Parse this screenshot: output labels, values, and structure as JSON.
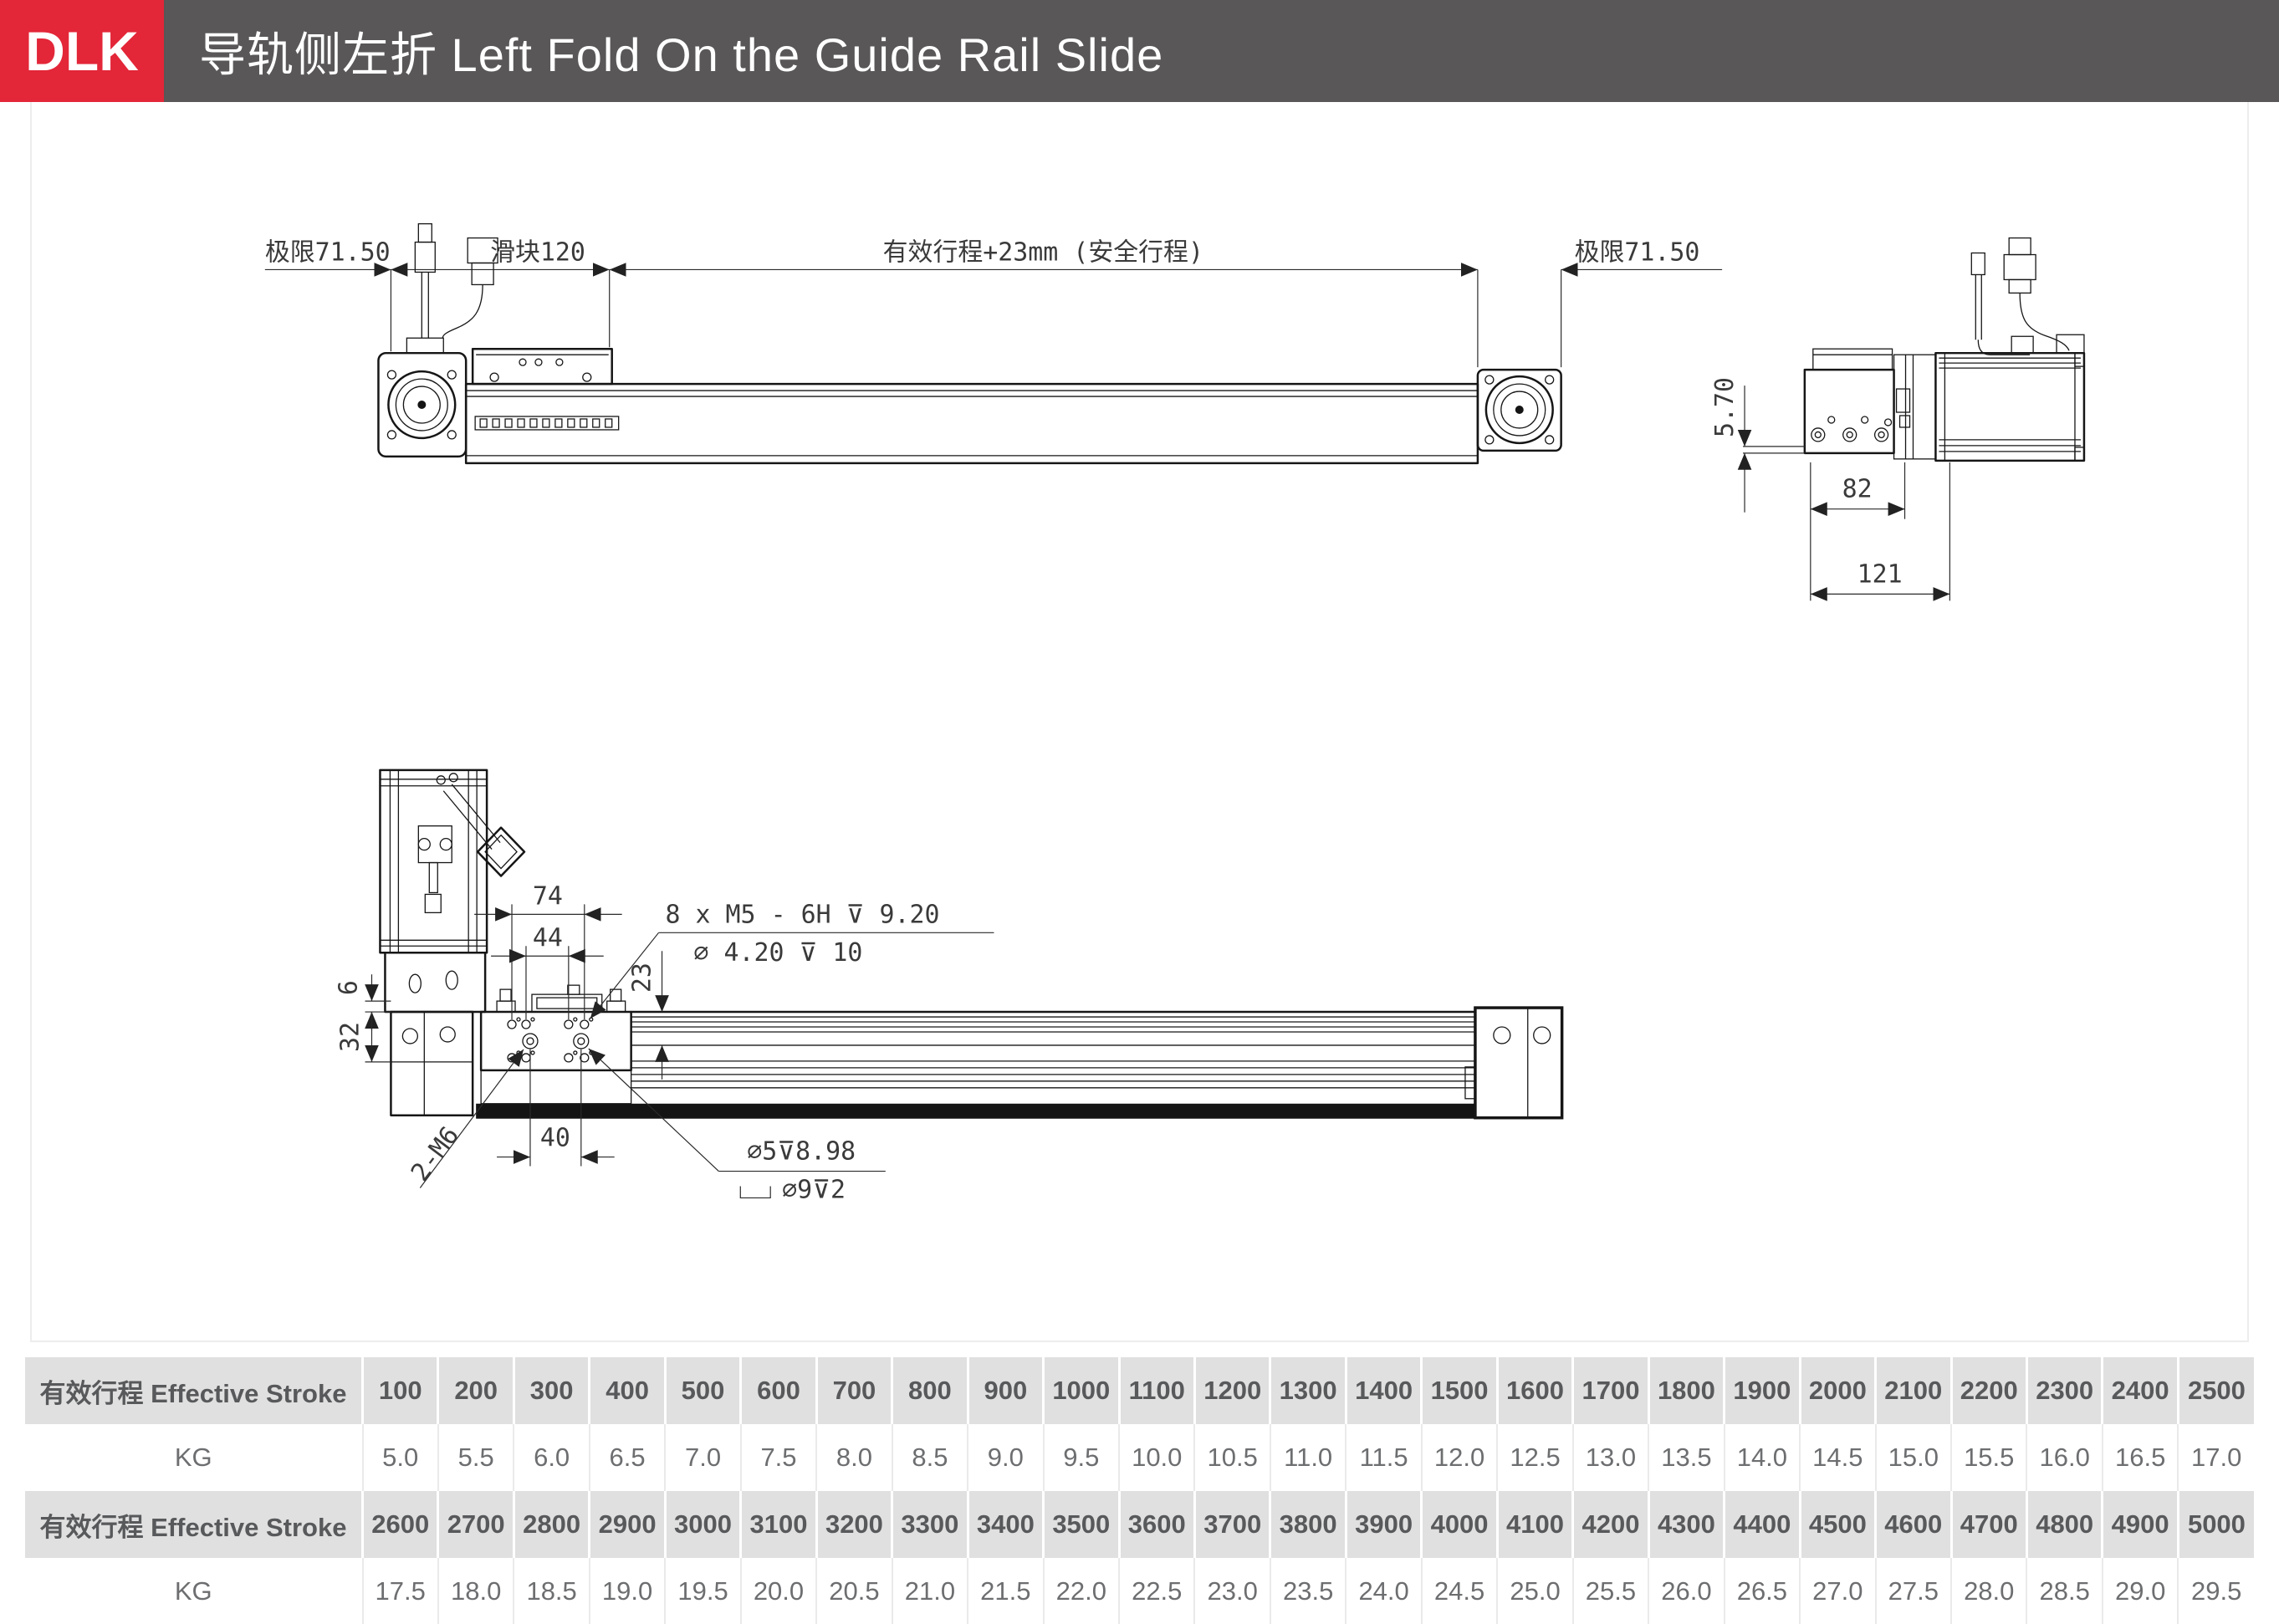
{
  "header": {
    "badge": "DLK",
    "title": "导轨侧左折 Left Fold On the Guide Rail Slide"
  },
  "colors": {
    "accent_red": "#e32638",
    "header_gray": "#595757",
    "table_header_bg": "#e0e0e0",
    "table_text": "#58595b",
    "line": "#161616"
  },
  "drawing": {
    "top_view": {
      "limit_left": "极限71.50",
      "slider_block": "滑块120",
      "effective_stroke": "有效行程+23mm (安全行程)",
      "limit_right": "极限71.50"
    },
    "end_view": {
      "offset": "5.70",
      "width_82": "82",
      "width_121": "121"
    },
    "plan_view": {
      "dim_74": "74",
      "dim_44": "44",
      "dim_6": "6",
      "dim_32": "32",
      "dim_23": "23",
      "dim_40": "40",
      "thread_note": "2-M6",
      "tap_note": "8 x M5 - 6H ⊽ 9.20",
      "drill_note": "∅ 4.20 ⊽ 10",
      "hole_note_top": "∅5⊽8.98",
      "hole_note_bottom": "∅9⊽2"
    }
  },
  "table": {
    "rows": [
      {
        "type": "header",
        "label": "有效行程 Effective Stroke",
        "values": [
          "100",
          "200",
          "300",
          "400",
          "500",
          "600",
          "700",
          "800",
          "900",
          "1000",
          "1100",
          "1200",
          "1300",
          "1400",
          "1500",
          "1600",
          "1700",
          "1800",
          "1900",
          "2000",
          "2100",
          "2200",
          "2300",
          "2400",
          "2500"
        ]
      },
      {
        "type": "data",
        "label": "KG",
        "values": [
          "5.0",
          "5.5",
          "6.0",
          "6.5",
          "7.0",
          "7.5",
          "8.0",
          "8.5",
          "9.0",
          "9.5",
          "10.0",
          "10.5",
          "11.0",
          "11.5",
          "12.0",
          "12.5",
          "13.0",
          "13.5",
          "14.0",
          "14.5",
          "15.0",
          "15.5",
          "16.0",
          "16.5",
          "17.0"
        ]
      },
      {
        "type": "header",
        "label": "有效行程 Effective Stroke",
        "values": [
          "2600",
          "2700",
          "2800",
          "2900",
          "3000",
          "3100",
          "3200",
          "3300",
          "3400",
          "3500",
          "3600",
          "3700",
          "3800",
          "3900",
          "4000",
          "4100",
          "4200",
          "4300",
          "4400",
          "4500",
          "4600",
          "4700",
          "4800",
          "4900",
          "5000"
        ]
      },
      {
        "type": "data",
        "label": "KG",
        "values": [
          "17.5",
          "18.0",
          "18.5",
          "19.0",
          "19.5",
          "20.0",
          "20.5",
          "21.0",
          "21.5",
          "22.0",
          "22.5",
          "23.0",
          "23.5",
          "24.0",
          "24.5",
          "25.0",
          "25.5",
          "26.0",
          "26.5",
          "27.0",
          "27.5",
          "28.0",
          "28.5",
          "29.0",
          "29.5"
        ]
      }
    ]
  }
}
